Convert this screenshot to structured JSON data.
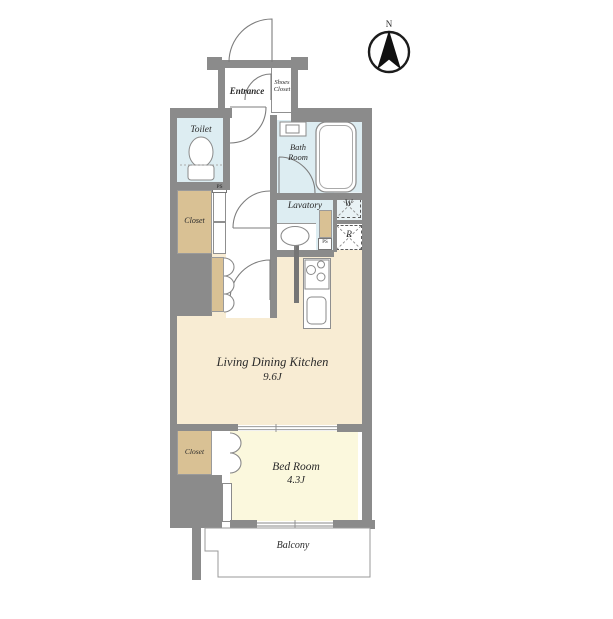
{
  "compass": {
    "north_label": "N"
  },
  "rooms": {
    "entrance": {
      "label": "Entrance"
    },
    "shoes_closet": {
      "line1": "Shoes",
      "line2": "Closet"
    },
    "toilet": {
      "label": "Toilet"
    },
    "bath": {
      "line1": "Bath",
      "line2": "Room"
    },
    "lavatory": {
      "label": "Lavatory"
    },
    "closet_upper": {
      "label": "Closet"
    },
    "ldk": {
      "label": "Living Dining Kitchen",
      "area": "9.6J"
    },
    "bedroom": {
      "label": "Bed Room",
      "area": "4.3J"
    },
    "closet_lower": {
      "label": "Closet"
    },
    "balcony": {
      "label": "Balcony"
    }
  },
  "markers": {
    "washer": "W",
    "refrigerator": "R",
    "pipe_space_upper": "PS",
    "pipe_space_lower": "PS"
  },
  "colors": {
    "wall": "#8b8b8b",
    "wet_room": "#ddedf2",
    "ldk_floor": "#f8ecd3",
    "bedroom_floor": "#fbf8dd",
    "closet": "#d9c194",
    "background": "#ffffff"
  }
}
